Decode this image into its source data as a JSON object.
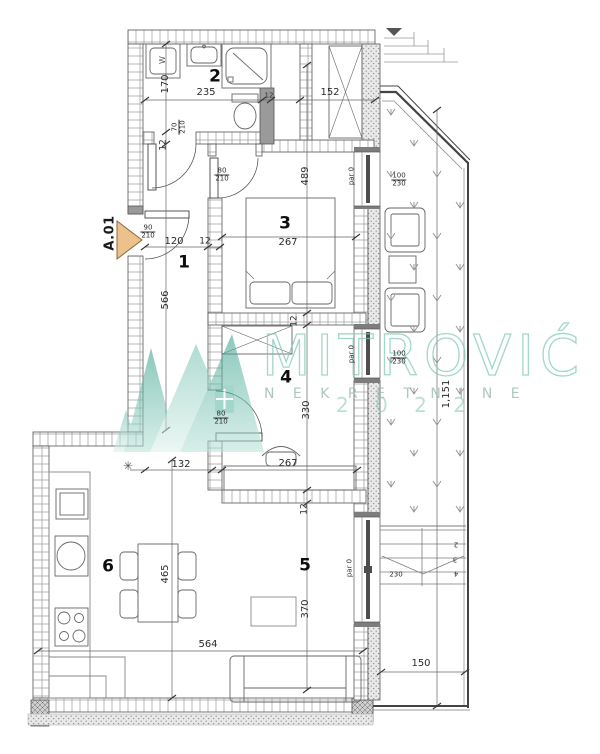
{
  "unit": {
    "label": "A.01"
  },
  "rooms": {
    "1": "1",
    "2": "2",
    "3": "3",
    "4": "4",
    "5": "5",
    "6": "6"
  },
  "dims": {
    "170": "170",
    "120": "120",
    "12": "12",
    "566": "566",
    "235": "235",
    "152": "152",
    "267": "267",
    "489": "489",
    "330": "330",
    "132": "132",
    "465": "465",
    "564": "564",
    "370": "370",
    "150": "150",
    "230": "230",
    "1151": "1,151",
    "par0": "par 0",
    "steps": {
      "2": "2",
      "3": "3",
      "4": "4"
    }
  },
  "fractions": {
    "entry_door": {
      "n": "90",
      "d": "210"
    },
    "bath_door": {
      "n": "70",
      "d": "210"
    },
    "room_door": {
      "n": "80",
      "d": "210"
    },
    "window": {
      "n": "100",
      "d": "230"
    }
  },
  "symbols": {
    "washer": "W",
    "light": "✳"
  },
  "colors": {
    "teal": "#7cc7b6",
    "arrow": "#ecc18b"
  },
  "watermark": {
    "brand": "MITROVIĆ",
    "tagline": "N E K R E T N I N E",
    "year": "2 0 2 2"
  }
}
